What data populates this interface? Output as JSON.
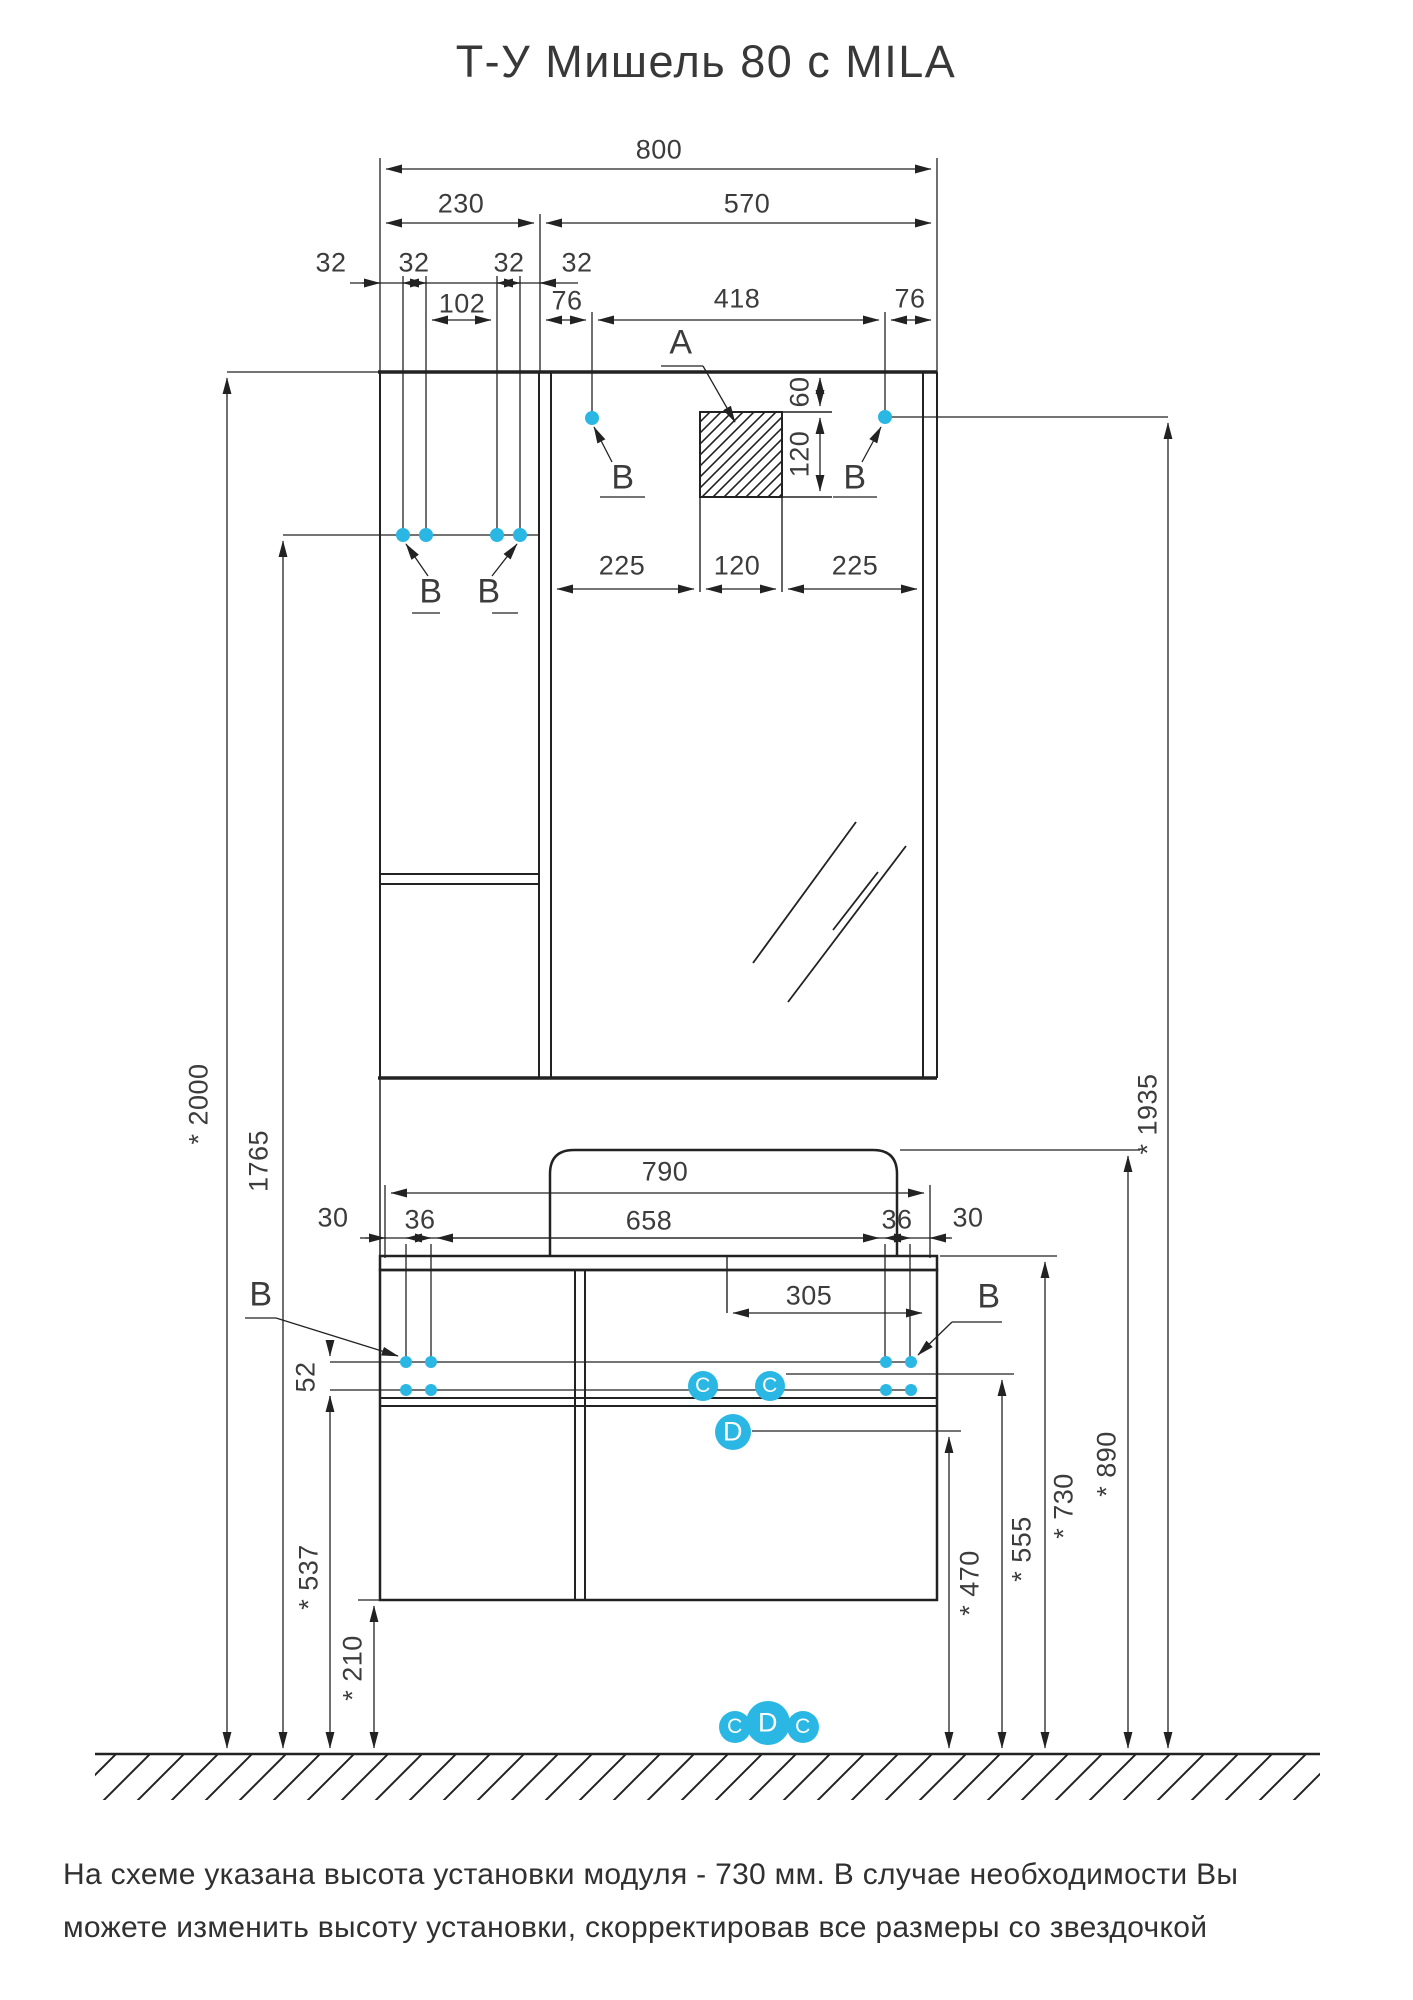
{
  "title": "Т-У Мишель 80 с MILA",
  "note": {
    "line1": "На схеме указана высота установки модуля - 730 мм. В случае необходимости Вы",
    "line2": "можете изменить высоту установки, скорректировав все размеры со звездочкой"
  },
  "colors": {
    "accent": "#2AB7E3",
    "line": "#222222",
    "text": "#3C3C3C"
  },
  "dims": {
    "total_width": "800",
    "cabinet_width": "230",
    "mirror_width": "570",
    "hole_offsets": [
      "32",
      "32",
      "32",
      "32"
    ],
    "hole_span": "102",
    "mirror_hole_left": "76",
    "mirror_hole_span": "418",
    "mirror_hole_right": "76",
    "recess_offset_top": "60",
    "recess_height": "120",
    "recess_left": "225",
    "recess_width": "120",
    "recess_right": "225",
    "top_width": "790",
    "basin_hole_span": "658",
    "basin_edge": [
      "30",
      "36",
      "36",
      "30"
    ],
    "drain_offset": "305",
    "row_gap": "52",
    "height_total": "* 2000",
    "height_upper_holes": "1765",
    "height_mirror_holes": "* 1935",
    "height_top": "* 890",
    "height_module": "* 730",
    "height_c": "* 555",
    "height_d": "* 470",
    "height_lower_holes": "* 537",
    "height_clearance": "* 210"
  },
  "markers": {
    "a": "A",
    "b": "B",
    "c": "C",
    "d": "D"
  }
}
